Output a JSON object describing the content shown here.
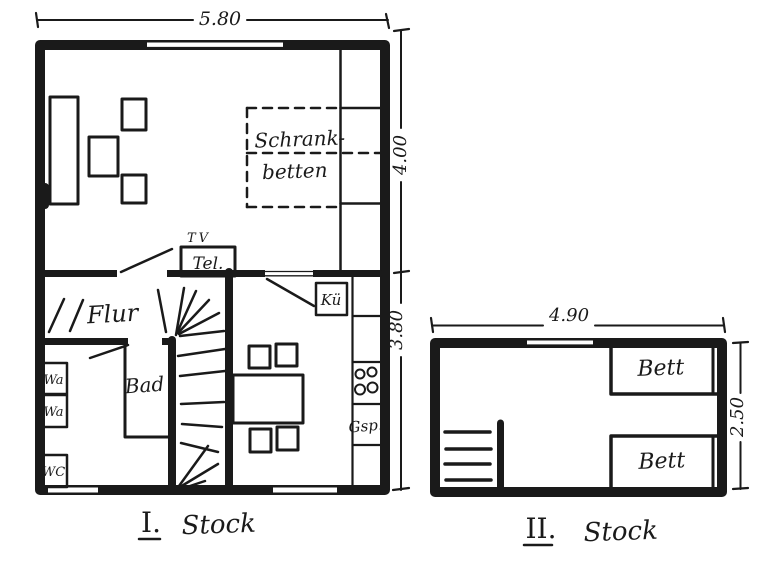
{
  "ink": "#1a1a1a",
  "paper": "#ffffff",
  "floor1": {
    "dims": {
      "top": "5.80",
      "right_upper": "4.00",
      "right_lower": "3.80"
    },
    "labels": {
      "schrank_line1": "Schrank-",
      "schrank_line2": "betten",
      "tv": "TV",
      "tel": "Tel.",
      "flur": "Flur",
      "bad": "Bad",
      "kueche": "Kü",
      "wa_top": "Wa",
      "wa_bottom": "Wa",
      "wc": "WC",
      "dishwasher": "Gsp."
    },
    "caption": {
      "numeral": "I.",
      "word": "Stock"
    }
  },
  "floor2": {
    "dims": {
      "top": "4.90",
      "right": "2.50"
    },
    "labels": {
      "bed_top": "Bett",
      "bed_bottom": "Bett"
    },
    "caption": {
      "numeral": "II.",
      "word": "Stock"
    }
  }
}
